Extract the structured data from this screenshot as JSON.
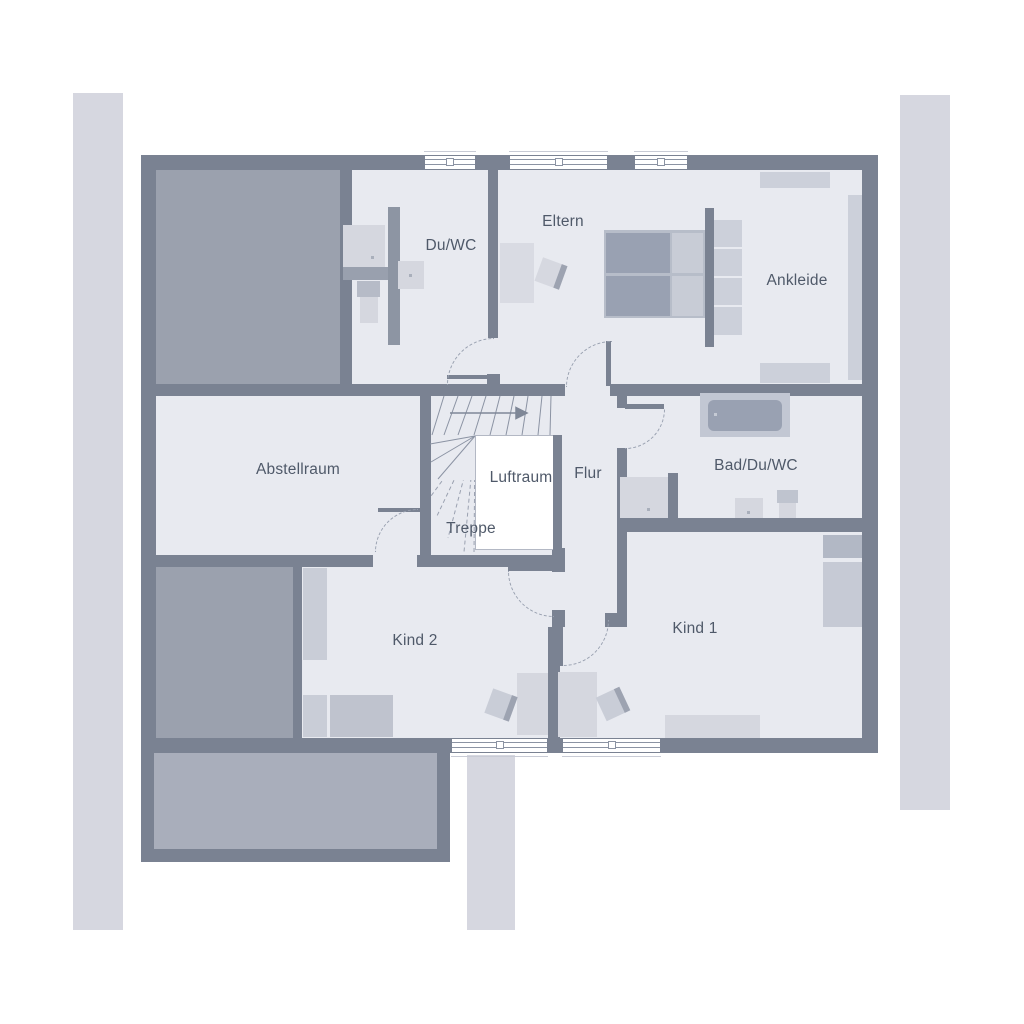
{
  "plan": {
    "rooms": [
      {
        "id": "du-wc",
        "label": "Du/WC"
      },
      {
        "id": "eltern",
        "label": "Eltern"
      },
      {
        "id": "ankleide",
        "label": "Ankleide"
      },
      {
        "id": "abstellraum",
        "label": "Abstellraum"
      },
      {
        "id": "luftraum",
        "label": "Luftraum"
      },
      {
        "id": "flur",
        "label": "Flur"
      },
      {
        "id": "treppe",
        "label": "Treppe"
      },
      {
        "id": "bad-du-wc",
        "label": "Bad/Du/WC"
      },
      {
        "id": "kind-1",
        "label": "Kind 1"
      },
      {
        "id": "kind-2",
        "label": "Kind 2"
      }
    ],
    "counts": {
      "windows": 5,
      "door_swings": 6
    },
    "palette": {
      "wall": "#7a8292",
      "floor": "#e8eaf0",
      "roof_area": "#9ba1ae",
      "balcony": "#a9aebb",
      "outside_strip": "#d6d7e0",
      "furniture_light": "#d5d7df",
      "furniture_medium": "#c2c7d3",
      "furniture_dark": "#99a1b2",
      "text": "#4f5969",
      "background": "#ffffff"
    }
  }
}
